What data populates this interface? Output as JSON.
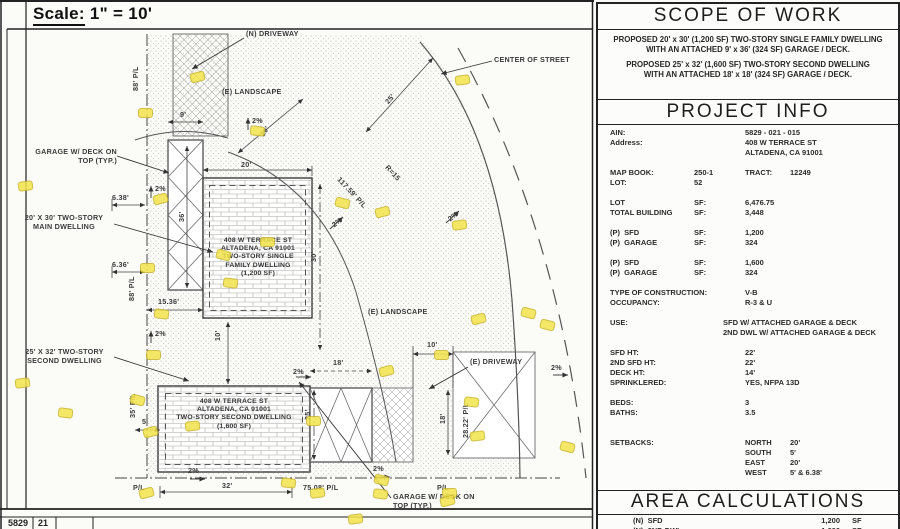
{
  "sheet": {
    "scale_word": "Scale:",
    "scale_value": "1\" = 10'",
    "titleblock": [
      "5829",
      "21"
    ]
  },
  "plan": {
    "highlight_color": "#f2e44c",
    "buildings": [
      {
        "name": "main-dwelling",
        "lines": [
          "408 W TERRACE ST",
          "ALTADENA, CA 91001",
          "TWO-STORY SINGLE",
          "FAMILY DWELLING",
          "(1,200 SF)"
        ]
      },
      {
        "name": "second-dwelling",
        "lines": [
          "408 W TERRACE ST",
          "ALTADENA, CA 91001",
          "TWO-STORY SECOND DWELLING",
          "(1,600 SF)"
        ]
      }
    ],
    "labels": [
      {
        "n": "label-n-driveway",
        "t": "(N) DRIVEWAY",
        "x": 246,
        "y": 29
      },
      {
        "n": "label-center-of-street",
        "t": "CENTER OF STREET",
        "x": 494,
        "y": 55
      },
      {
        "n": "label-e-landscape-top",
        "t": "(E) LANDSCAPE",
        "x": 222,
        "y": 87
      },
      {
        "n": "dim-9ft",
        "t": "9'",
        "x": 180,
        "y": 110
      },
      {
        "n": "slope-2pct-1",
        "t": "2%",
        "x": 252,
        "y": 116
      },
      {
        "n": "dim-20ft-diagonal",
        "t": "20'",
        "x": 258,
        "y": 133,
        "r": -56
      },
      {
        "n": "dim-25ft-diagonal",
        "t": "25'",
        "x": 383,
        "y": 100,
        "r": -50
      },
      {
        "n": "dim-117-59-pl",
        "t": "117.59' P/L",
        "x": 342,
        "y": 175,
        "r": 47
      },
      {
        "n": "dim-r15",
        "t": "R=15",
        "x": 390,
        "y": 163,
        "r": 47
      },
      {
        "n": "label-garage-deck-top",
        "t": "GARAGE W/ DECK ON\nTOP (TYP.)",
        "x": 22,
        "y": 147,
        "w": 95,
        "align": "right"
      },
      {
        "n": "dim-6-38ft",
        "t": "6.38'",
        "x": 112,
        "y": 193
      },
      {
        "n": "slope-2pct-2",
        "t": "2%",
        "x": 155,
        "y": 184
      },
      {
        "n": "label-main-dwelling",
        "t": "20' X 30' TWO-STORY\nMAIN DWELLING",
        "x": 14,
        "y": 213,
        "w": 100,
        "align": "center"
      },
      {
        "n": "dim-6-36ft",
        "t": "6.36'",
        "x": 112,
        "y": 260
      },
      {
        "n": "dim-36ft",
        "t": "36'",
        "x": 177,
        "y": 222,
        "r": -90
      },
      {
        "n": "dim-88ft-pl-upper",
        "t": "88' P/L",
        "x": 131,
        "y": 91,
        "r": -90
      },
      {
        "n": "dim-88ft-pl-lower",
        "t": "88' P/L",
        "x": 127,
        "y": 301,
        "r": -90
      },
      {
        "n": "dim-15-36ft",
        "t": "15.36'",
        "x": 158,
        "y": 297
      },
      {
        "n": "dim-20ft-top",
        "t": "20'",
        "x": 241,
        "y": 160
      },
      {
        "n": "dim-30ft",
        "t": "30'",
        "x": 309,
        "y": 262,
        "r": -90
      },
      {
        "n": "slope-2pct-3",
        "t": "2%",
        "x": 330,
        "y": 222,
        "r": -38
      },
      {
        "n": "slope-2pct-4",
        "t": "2%",
        "x": 446,
        "y": 216,
        "r": -38
      },
      {
        "n": "label-e-landscape-mid",
        "t": "(E) LANDSCAPE",
        "x": 368,
        "y": 307
      },
      {
        "n": "label-second-dwelling",
        "t": "25' X 32' TWO-STORY\nSECOND DWELLING",
        "x": 12,
        "y": 347,
        "w": 105,
        "align": "center"
      },
      {
        "n": "dim-10ft-between",
        "t": "10'",
        "x": 213,
        "y": 341,
        "r": -90
      },
      {
        "n": "dim-35ft-pl",
        "t": "35' P/L",
        "x": 128,
        "y": 418,
        "r": -90
      },
      {
        "n": "dim-5ft",
        "t": "5'",
        "x": 142,
        "y": 417
      },
      {
        "n": "slope-2pct-5",
        "t": "2%",
        "x": 155,
        "y": 329
      },
      {
        "n": "dim-18ft-garage",
        "t": "18'",
        "x": 333,
        "y": 358
      },
      {
        "n": "dim-25ft-garage",
        "t": "25'",
        "x": 303,
        "y": 420,
        "r": -90
      },
      {
        "n": "dim-10ft-driveway",
        "t": "10'",
        "x": 427,
        "y": 340
      },
      {
        "n": "label-e-driveway",
        "t": "(E) DRIVEWAY",
        "x": 470,
        "y": 357
      },
      {
        "n": "dim-18ft-driveway",
        "t": "18'",
        "x": 438,
        "y": 424,
        "r": -90
      },
      {
        "n": "dim-28-22-pl",
        "t": "28.22' P/L",
        "x": 461,
        "y": 438,
        "r": -90
      },
      {
        "n": "slope-2pct-6",
        "t": "2%",
        "x": 293,
        "y": 367
      },
      {
        "n": "slope-2pct-7",
        "t": "2%",
        "x": 188,
        "y": 466
      },
      {
        "n": "slope-2pct-8",
        "t": "2%",
        "x": 373,
        "y": 464
      },
      {
        "n": "slope-2pct-9",
        "t": "2%",
        "x": 551,
        "y": 363
      },
      {
        "n": "label-pl-bottom-left",
        "t": "P/L",
        "x": 133,
        "y": 483
      },
      {
        "n": "dim-32ft",
        "t": "32'",
        "x": 222,
        "y": 481
      },
      {
        "n": "dim-75-08-pl",
        "t": "75.08' P/L",
        "x": 303,
        "y": 483
      },
      {
        "n": "label-pl-bottom-right",
        "t": "P/L",
        "x": 437,
        "y": 483
      },
      {
        "n": "label-garage-deck-bottom",
        "t": "GARAGE W/ DECK ON\nTOP (TYP.)",
        "x": 393,
        "y": 492
      }
    ],
    "highlights": [
      [
        190,
        72
      ],
      [
        455,
        75
      ],
      [
        138,
        108
      ],
      [
        250,
        126
      ],
      [
        335,
        198
      ],
      [
        153,
        194
      ],
      [
        18,
        181
      ],
      [
        260,
        237
      ],
      [
        223,
        278
      ],
      [
        216,
        250
      ],
      [
        375,
        207
      ],
      [
        452,
        220
      ],
      [
        140,
        263
      ],
      [
        154,
        309
      ],
      [
        521,
        308
      ],
      [
        471,
        314
      ],
      [
        15,
        378
      ],
      [
        146,
        350
      ],
      [
        58,
        408
      ],
      [
        130,
        395
      ],
      [
        143,
        427
      ],
      [
        185,
        421
      ],
      [
        306,
        416
      ],
      [
        464,
        397
      ],
      [
        540,
        320
      ],
      [
        379,
        366
      ],
      [
        470,
        431
      ],
      [
        434,
        350
      ],
      [
        281,
        478
      ],
      [
        374,
        475
      ],
      [
        139,
        488
      ],
      [
        310,
        488
      ],
      [
        442,
        488
      ],
      [
        373,
        489
      ],
      [
        560,
        442
      ],
      [
        440,
        496
      ],
      [
        348,
        514
      ]
    ]
  },
  "panel": {
    "scope": {
      "title": "SCOPE OF WORK",
      "paragraphs": [
        "PROPOSED 20' x 30' (1,200 SF) TWO-STORY SINGLE FAMILY DWELLING\nWITH AN ATTACHED 9' x 36' (324 SF) GARAGE / DECK.",
        "PROPOSED 25' x 32' (1,600 SF) TWO-STORY SECOND DWELLING\nWITH AN ATTACHED 18' x 18' (324 SF) GARAGE / DECK."
      ]
    },
    "project_info": {
      "title": "PROJECT INFO",
      "rows": [
        {
          "a": "AIN:",
          "c": "5829 - 021 - 015"
        },
        {
          "a": "Address:",
          "c": "408 W TERRACE ST"
        },
        {
          "c": "ALTADENA, CA 91001"
        },
        {},
        {
          "a": "MAP BOOK:",
          "b": "250-1",
          "c": "TRACT:",
          "d": "12249"
        },
        {
          "a": "LOT:",
          "b": "52"
        },
        {},
        {
          "a": "LOT",
          "b": "SF:",
          "c": "6,476.75"
        },
        {
          "a": "TOTAL BUILDING",
          "b": "SF:",
          "c": "3,448"
        },
        {},
        {
          "a": "(P)  SFD",
          "b": "SF:",
          "c": "1,200"
        },
        {
          "a": "(P)  GARAGE",
          "b": "SF:",
          "c": "324"
        },
        {},
        {
          "a": "(P)  SFD",
          "b": "SF:",
          "c": "1,600"
        },
        {
          "a": "(P)  GARAGE",
          "b": "SF:",
          "c": "324"
        },
        {},
        {
          "a": "TYPE OF CONSTRUCTION:",
          "c": "V-B"
        },
        {
          "a": "OCCUPANCY:",
          "c": "R-3 & U"
        },
        {},
        {
          "a": "USE:",
          "c": "SFD W/ ATTACHED GARAGE & DECK",
          "wide": true
        },
        {
          "c": "2ND DWL W/ ATTACHED GARAGE & DECK",
          "wide": true
        },
        {},
        {
          "a": "SFD HT:",
          "c": "22'"
        },
        {
          "a": "2ND SFD HT:",
          "c": "22'"
        },
        {
          "a": "DECK HT:",
          "c": "14'"
        },
        {
          "a": "SPRINKLERED:",
          "c": "YES, NFPA 13D"
        },
        {},
        {
          "a": "BEDS:",
          "c": "3"
        },
        {
          "a": "BATHS:",
          "c": "3.5"
        },
        {},
        {},
        {
          "a": "SETBACKS:",
          "c": "NORTH",
          "d": "20'"
        },
        {
          "c": "SOUTH",
          "d": "5'"
        },
        {
          "c": "EAST",
          "d": "20'"
        },
        {
          "c": "WEST",
          "d": "5' & 6.38'"
        }
      ]
    },
    "area": {
      "title": "AREA CALCULATIONS",
      "rows": [
        {
          "c1": "(N)  SFD",
          "c2": "1,200",
          "c3": "SF"
        },
        {
          "c1": "(N)  2ND DWL",
          "c2": "1,600",
          "c3": "SF"
        }
      ]
    }
  }
}
